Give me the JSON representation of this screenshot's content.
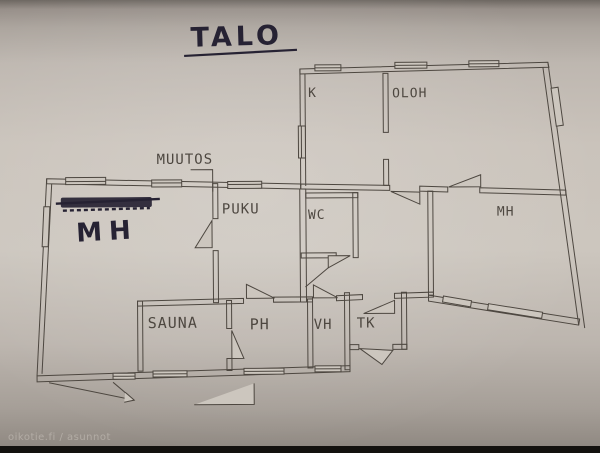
{
  "page": {
    "title": "TALO",
    "watermark": "oikotie.fi / asunnot"
  },
  "annotations": {
    "muutos_label": "MUUTOS",
    "handwritten_bedroom": "MH",
    "scribbled_text": ""
  },
  "rooms": {
    "kitchen": "K",
    "living_room": "OLOH",
    "dressing_room": "PUKU",
    "wc": "WC",
    "bedroom_right": "MH",
    "sauna": "SAUNA",
    "washroom": "PH",
    "hallway_closet": "VH",
    "vestibule": "TK"
  },
  "colors": {
    "paper": "#ccc6be",
    "plan_line": "#4d4740",
    "ink": "#262233",
    "bottom_bar": "#13110e"
  }
}
